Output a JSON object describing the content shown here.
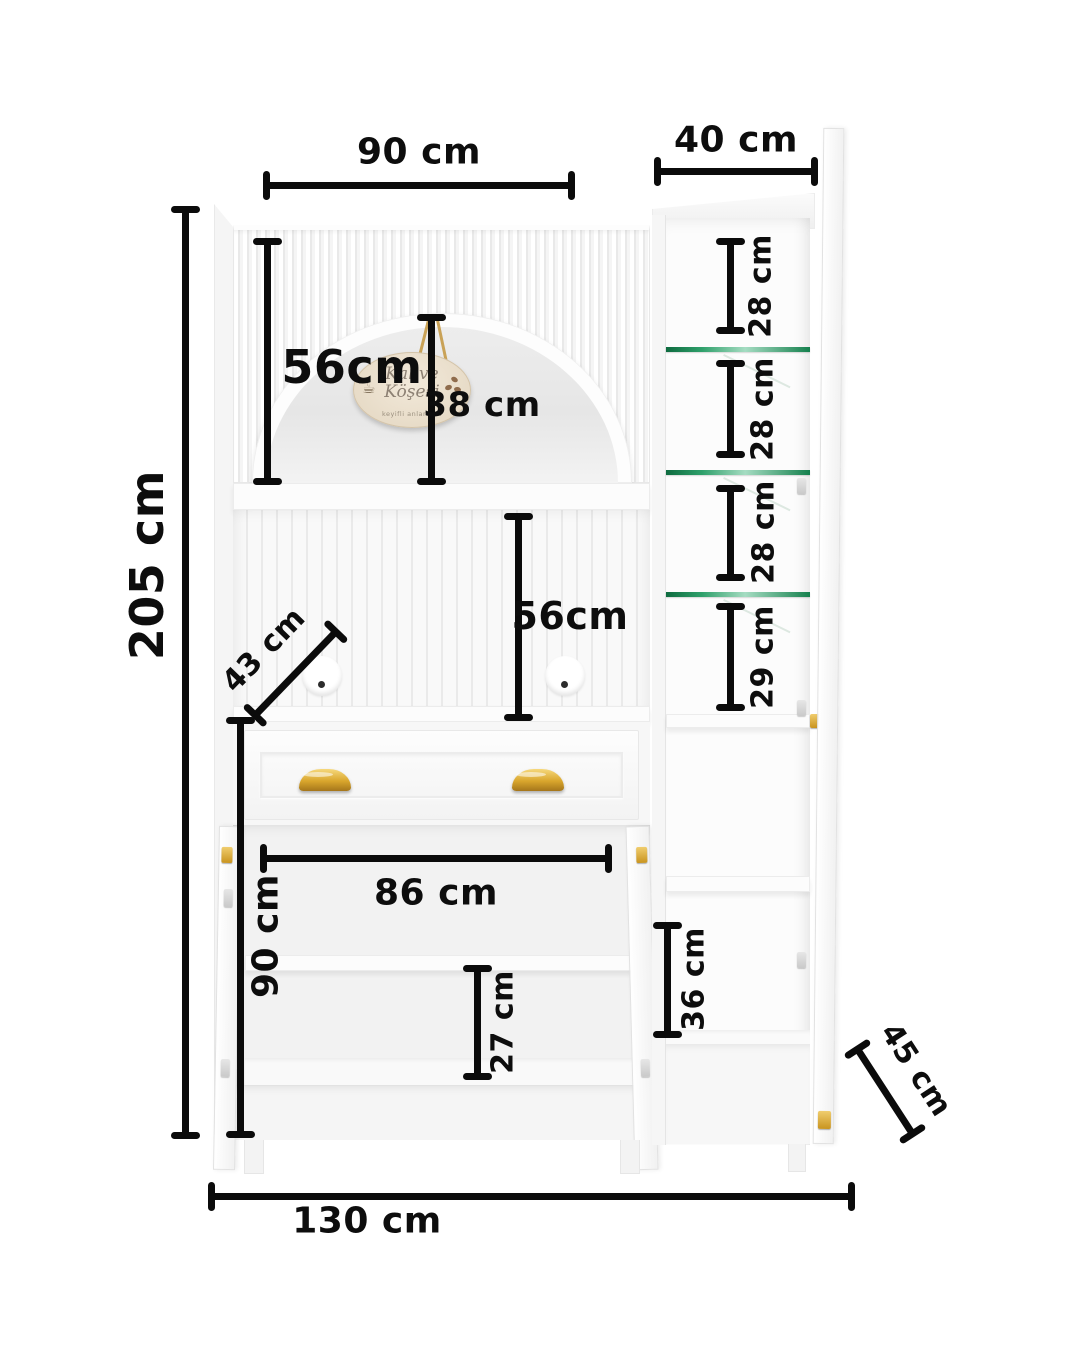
{
  "diagram": {
    "description": "White kitchen hutch cabinet dimension diagram, front view with open doors",
    "colors": {
      "background": "#ffffff",
      "dimension_line": "#0b0b0b",
      "cabinet_white": "#fcfcfc",
      "niche_gray": "#ebebeb",
      "glass_shelf_green": "#15804d",
      "handle_gold": "#d9a62c",
      "sign_beige": "#e9ddc8"
    },
    "labels": {
      "total_height": "205 cm",
      "total_width": "130 cm",
      "top_main_width": "90 cm",
      "top_side_width": "40 cm",
      "upper_section_height": "56cm",
      "arch_niche_height": "38 cm",
      "middle_open_height": "56cm",
      "middle_depth_diagonal": "43 cm",
      "side_shelf_gap_1": "28 cm",
      "side_shelf_gap_2": "28 cm",
      "side_shelf_gap_3": "28 cm",
      "side_shelf_gap_4": "29 cm",
      "lower_inner_width": "86 cm",
      "lower_section_height": "90 cm",
      "lower_shelf_gap": "27 cm",
      "side_lower_gap": "36 cm",
      "depth_diagonal": "45 cm"
    },
    "sign": {
      "line1": "Kahve",
      "line2": "Köşesi",
      "line3": "keyifli anlar için",
      "coffee_icon": "☕"
    }
  }
}
